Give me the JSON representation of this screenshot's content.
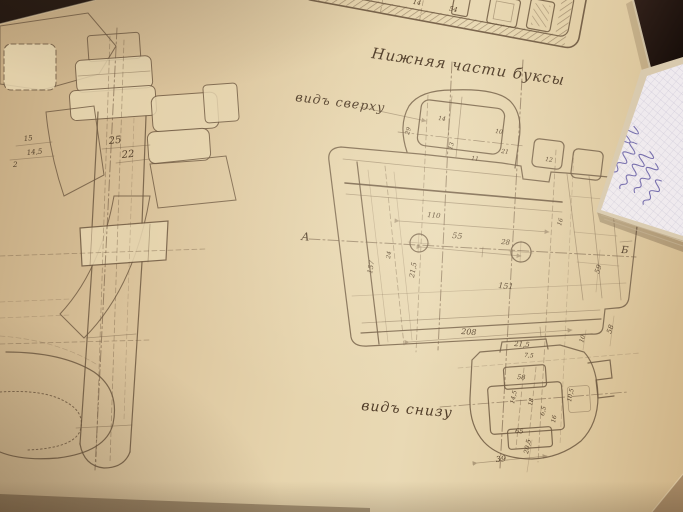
{
  "labels": {
    "title": "Нижняя части буксы",
    "view_top": "видъ сверху",
    "view_bottom": "видъ снизу",
    "section_a": "А",
    "section_b": "Б"
  },
  "dimensions": {
    "left_section": [
      "15",
      "14,5",
      "2",
      "25",
      "22"
    ],
    "top_fragment": [
      "28",
      "14",
      "54"
    ],
    "top_boss": [
      "29",
      "14",
      "10",
      "13",
      "11",
      "21",
      "12"
    ],
    "plan": [
      "110",
      "55",
      "28",
      "151",
      "21,5",
      "157",
      "24",
      "16",
      "59",
      "58",
      "10",
      "208",
      "21,5"
    ],
    "bottom_view": [
      "7,5",
      "58",
      "14,5",
      "18",
      "6,5",
      "16",
      "10,5",
      "65",
      "20,5",
      "39"
    ]
  }
}
